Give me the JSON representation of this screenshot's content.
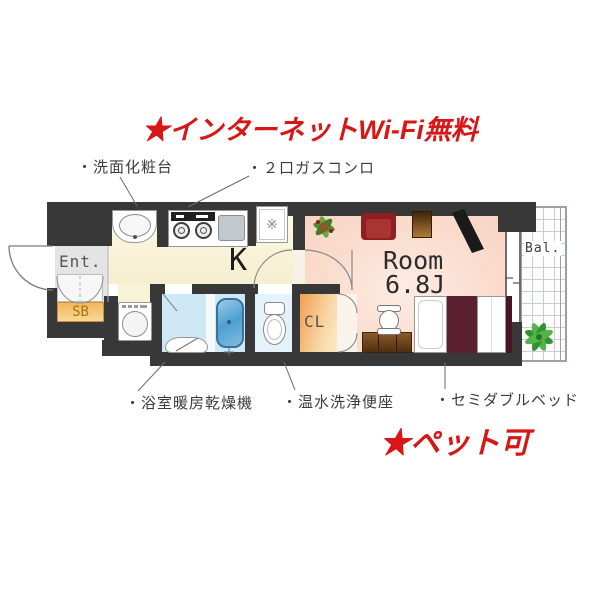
{
  "banners": {
    "top": "★インターネットWi-Fi無料",
    "bottom": "★ペット可"
  },
  "callouts": {
    "washbasin": "・洗面化粧台",
    "gas_stove": "・２口ガスコンロ",
    "bath_dryer": "・浴室暖房乾燥機",
    "washlet": "・温水洗浄便座",
    "bed": "・セミダブルベッド"
  },
  "plan": {
    "entrance": "Ent.",
    "shoebox": "SB",
    "kitchen": "K",
    "room": "Room",
    "room_size": "6.8J",
    "closet": "CL",
    "balcony": "Bal.",
    "fridge_symbol": "※"
  },
  "colors": {
    "accent_red": "#d91616",
    "wall": "#383838",
    "kitchen_floor": "#fbf5dc",
    "room_floor": "#fadccd",
    "bathroom_floor": "#cfe8f5",
    "toilet_floor": "#e4f2fa",
    "closet_orange": "#f5b469",
    "shoebox_orange": "#f5c06a",
    "entrance_floor": "#e4e4e4",
    "tub_blue": "#5aa5d4",
    "bed_cover_maroon": "#5a2030",
    "sofa_red": "#962226",
    "balcony_grid_gray": "#c9ccd0"
  }
}
